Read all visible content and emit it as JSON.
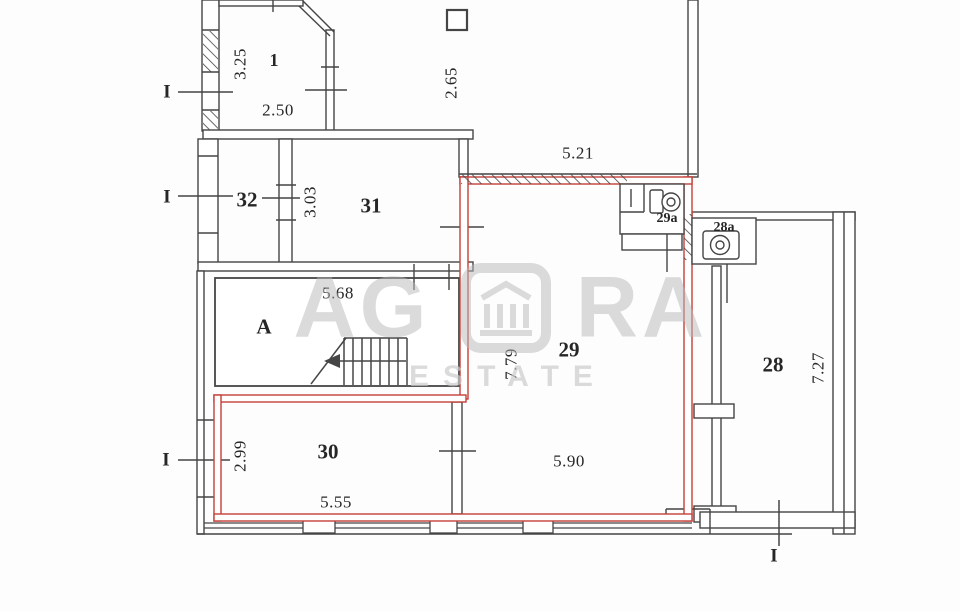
{
  "rooms": [
    {
      "id": "1",
      "label": "1"
    },
    {
      "id": "32",
      "label": "32"
    },
    {
      "id": "31",
      "label": "31"
    },
    {
      "id": "A",
      "label": "A"
    },
    {
      "id": "29a",
      "label": "29a"
    },
    {
      "id": "28a",
      "label": "28a"
    },
    {
      "id": "29",
      "label": "29"
    },
    {
      "id": "28",
      "label": "28"
    },
    {
      "id": "30",
      "label": "30"
    }
  ],
  "dimensions": [
    {
      "value": "3.25",
      "axis": "vertical"
    },
    {
      "value": "2.50",
      "axis": "horizontal"
    },
    {
      "value": "2.65",
      "axis": "vertical"
    },
    {
      "value": "5.21",
      "axis": "horizontal"
    },
    {
      "value": "3.03",
      "axis": "vertical"
    },
    {
      "value": "5.68",
      "axis": "horizontal"
    },
    {
      "value": "7.79",
      "axis": "vertical"
    },
    {
      "value": "7.27",
      "axis": "vertical"
    },
    {
      "value": "2.99",
      "axis": "vertical"
    },
    {
      "value": "5.55",
      "axis": "horizontal"
    },
    {
      "value": "5.90",
      "axis": "horizontal"
    }
  ],
  "section_markers": [
    {
      "label": "I"
    },
    {
      "label": "I"
    },
    {
      "label": "I"
    },
    {
      "label": "I"
    }
  ],
  "watermark": {
    "text_left": "AG",
    "text_right": "RA",
    "tagline": "ESTATE",
    "logo": "portico-columns-icon"
  },
  "colors": {
    "wall": "#454545",
    "unit_highlight": "#c4403a",
    "text": "#262626",
    "watermark": "#b9b9b9"
  }
}
